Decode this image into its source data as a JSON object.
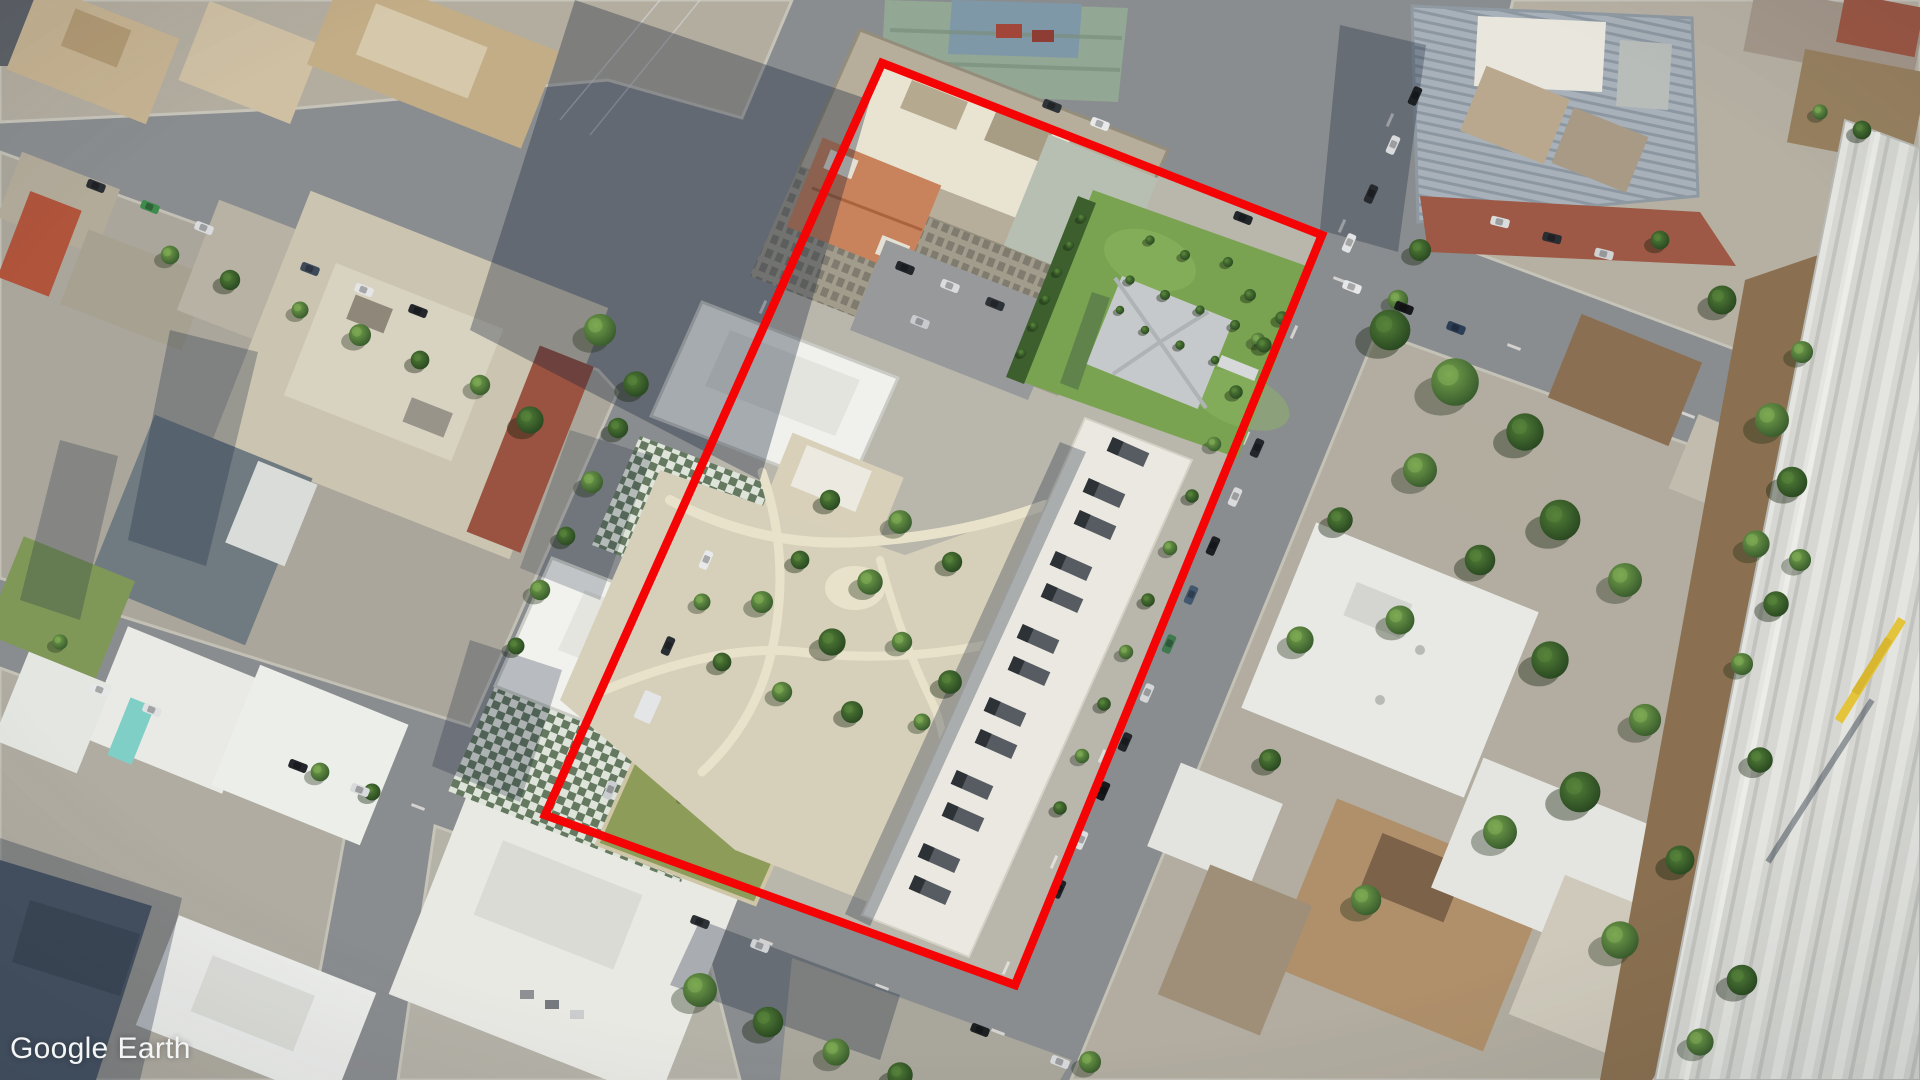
{
  "app": {
    "name": "Google Earth"
  },
  "watermark": {
    "google": "Google",
    "earth": "Earth",
    "color": "#f3f5f6"
  },
  "annotation": {
    "kind": "site-boundary-polygon",
    "color": "#f40404",
    "stroke_width": 8.5,
    "points": "882,63 1322,235 1015,985 545,815"
  }
}
